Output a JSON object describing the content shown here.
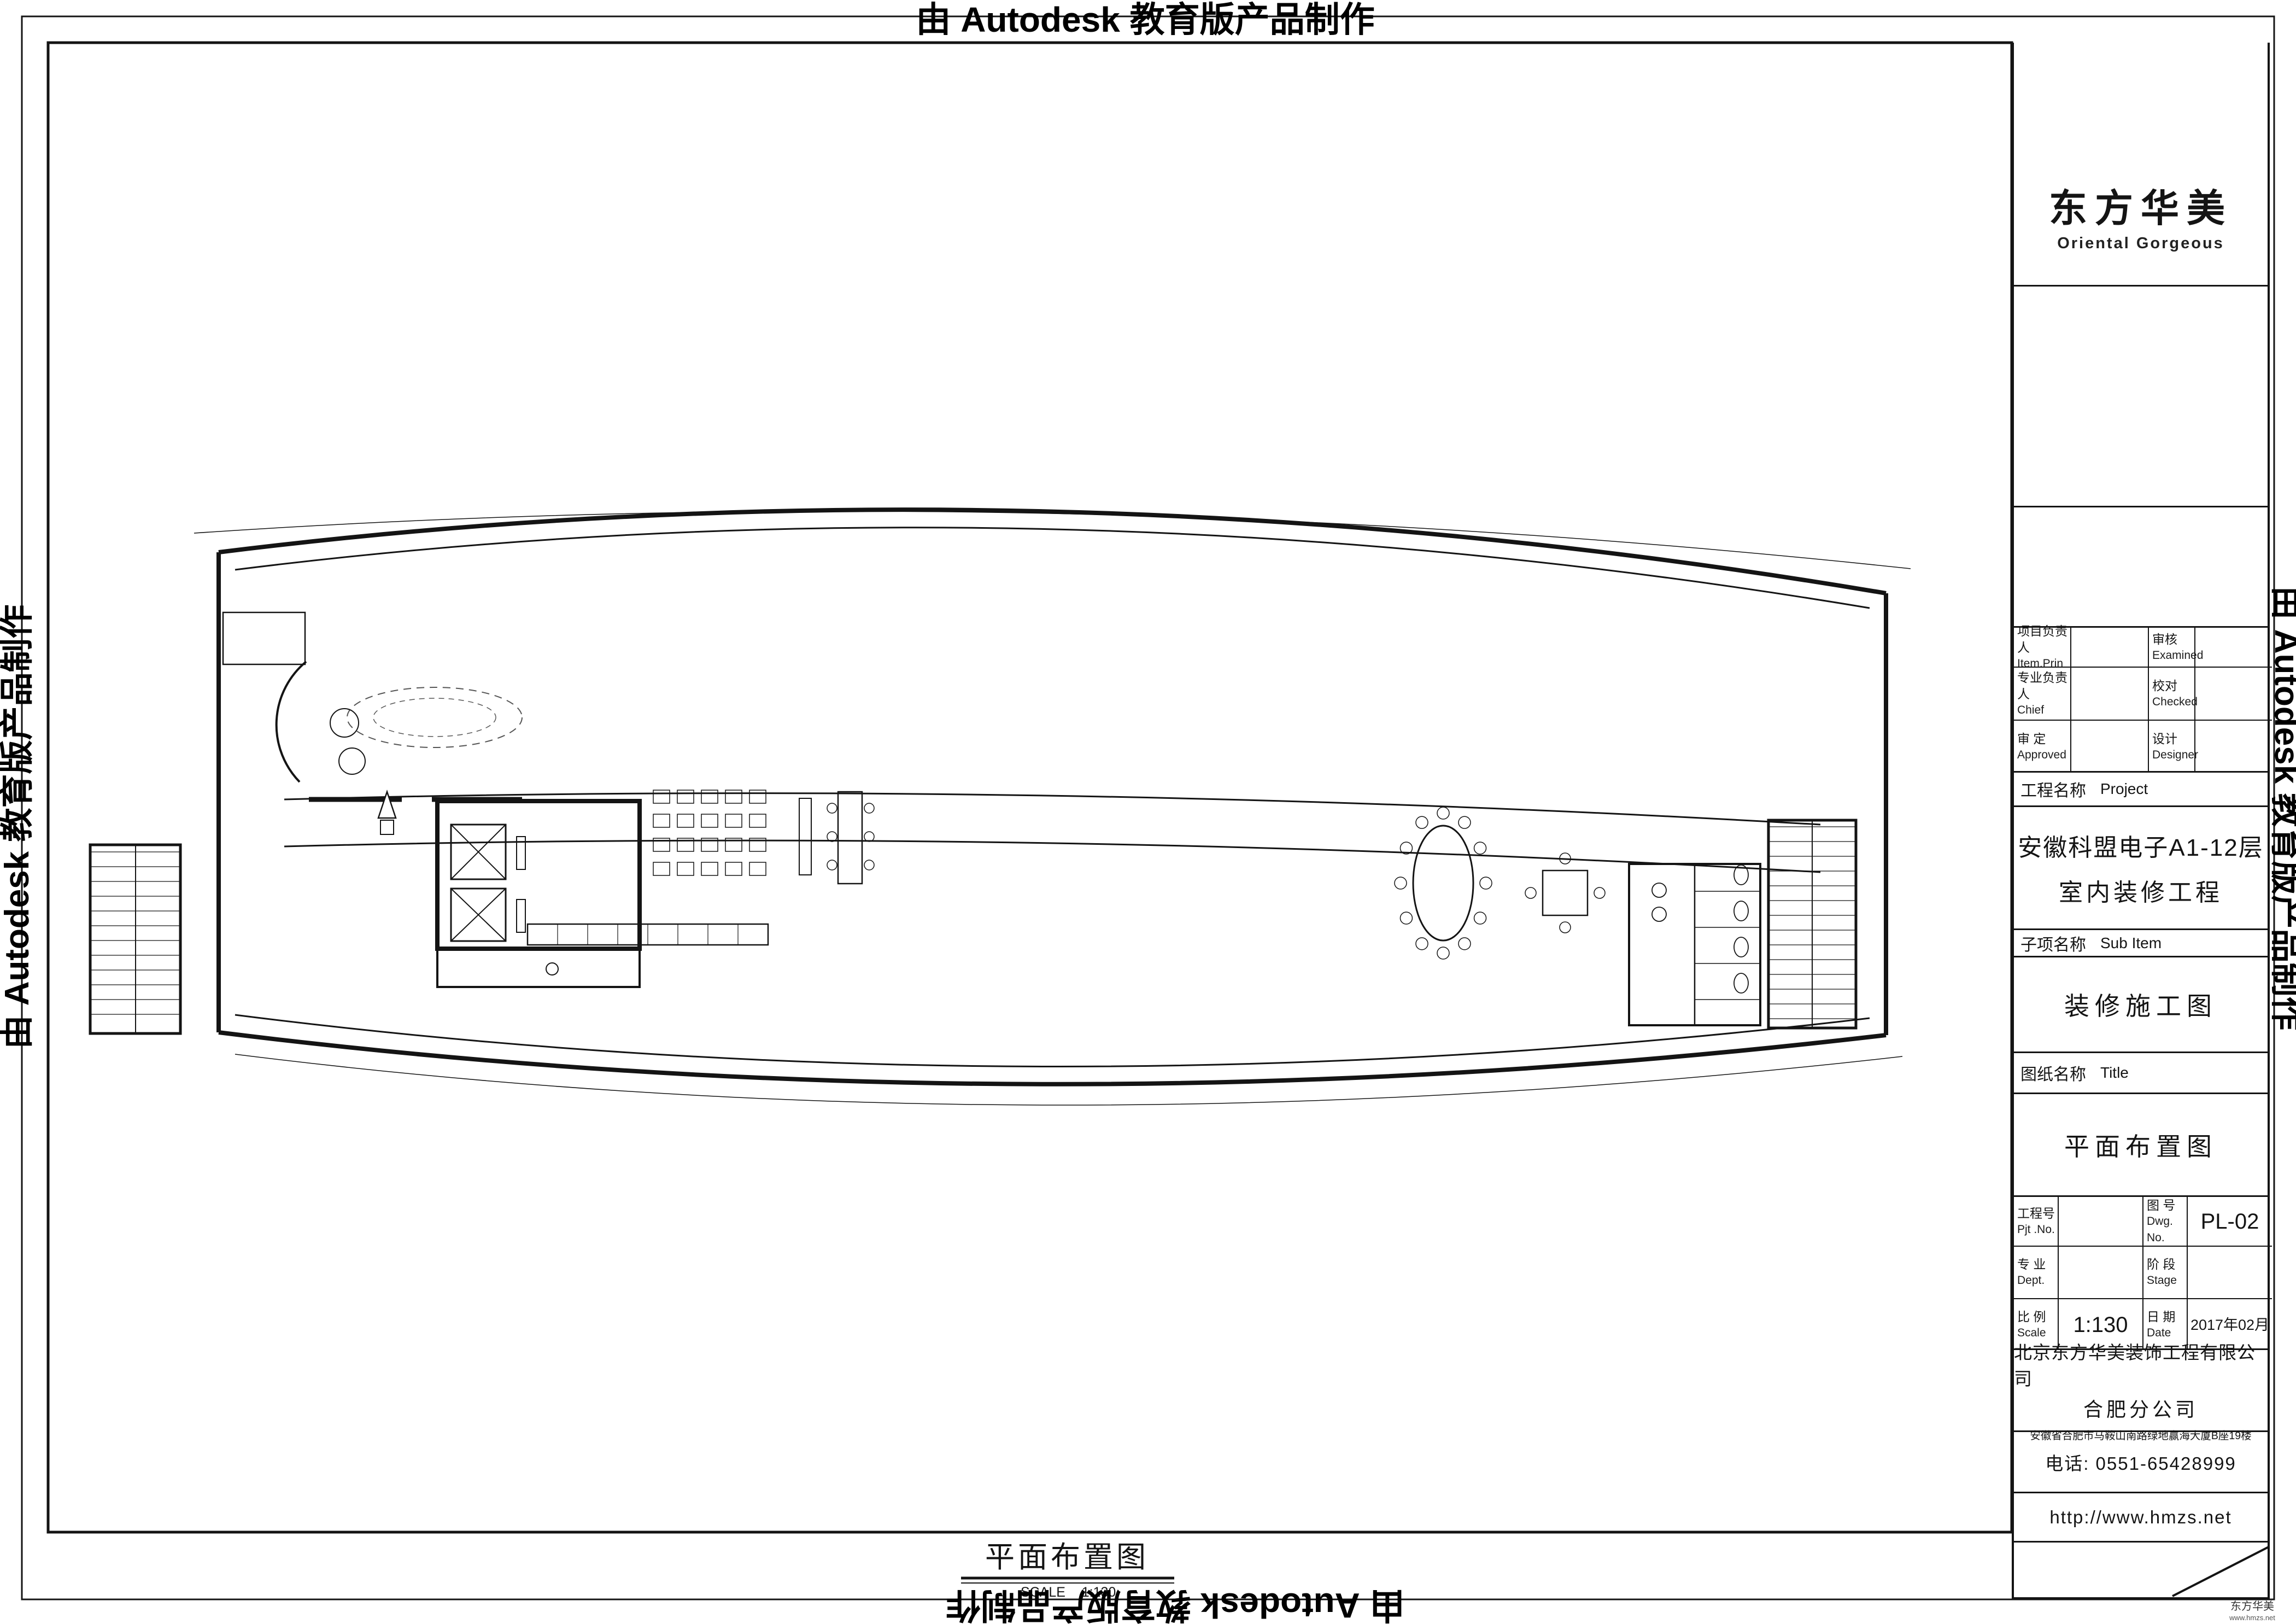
{
  "watermark": "由 Autodesk 教育版产品制作",
  "sheet": {
    "caption_title": "平面布置图",
    "caption_scale_label": "SCALE",
    "caption_scale_value": "1:130",
    "corner_brand": "东方华美",
    "corner_url": "www.hmzs.net"
  },
  "title_block": {
    "logo": {
      "brand_cn": "东方华美",
      "brand_en": "Oriental Gorgeous",
      "accent_color": "#e8141c"
    },
    "copyright_en": [
      "ORIENTAL GORGEOUS EXPRESSLY RESERVES",
      "ITS COMMON LAW COPYRIGHT AND OTHER",
      "PROPERTY RIGHTS IN THESE PLANS.THESE",
      "PLANS ARE NOT TO BE REPRODUCED CHANGED",
      "OR COPIED IN ANY FORM OR MANNER",
      "WHATSOEVER.NOR ARE THEY TO BE ASSIGHED",
      "TO ANY THIRD PARTY WITHOUT FIRST",
      "OBTAINING THE EXPRESSED WRITTEN",
      "PERMISSION AND CONSENT OF ORIENTAL",
      "GORGEOUS"
    ],
    "copyright_cn": [
      "东方华美对本方案拥有版权及所有权。",
      "本方案不得以任何方式修改及复制。",
      "未经东方华美书面授权，本方案不得向",
      "任何第三方转让。"
    ],
    "personnel": {
      "rows": [
        {
          "l1": "项目负责人",
          "l2": "Item.Prin",
          "r1": "审核",
          "r2": "Examined"
        },
        {
          "l1": "专业负责人",
          "l2": "Chief",
          "r1": "校对",
          "r2": "Checked"
        },
        {
          "l1": "审 定",
          "l2": "Approved",
          "r1": "设计",
          "r2": "Designer"
        }
      ]
    },
    "project_label": "工程名称",
    "project_label_en": "Project",
    "project_name_line1": "安徽科盟电子A1-12层",
    "project_name_line2": "室内装修工程",
    "subitem_label": "子项名称",
    "subitem_label_en": "Sub Item",
    "subitem_value": "装修施工图",
    "sheetname_label": "图纸名称",
    "sheetname_label_en": "Title",
    "sheetname_value": "平面布置图",
    "meta": {
      "rows": [
        {
          "l1": "工程号",
          "l2": "Pjt .No.",
          "v1": "",
          "r1": "图 号",
          "r2": "Dwg. No.",
          "v2": "PL-02"
        },
        {
          "l1": "专 业",
          "l2": "Dept.",
          "v1": "",
          "r1": "阶 段",
          "r2": "Stage",
          "v2": ""
        },
        {
          "l1": "比 例",
          "l2": "Scale",
          "v1": "1:130",
          "r1": "日 期",
          "r2": "Date",
          "v2": "2017年02月"
        }
      ]
    },
    "company": {
      "name": "北京东方华美装饰工程有限公司",
      "branch": "合肥分公司",
      "address": "安徽省合肥市马鞍山南路绿地赢海大厦B座19楼",
      "phone": "电话: 0551-65428999",
      "website": "http://www.hmzs.net"
    }
  },
  "plan": {
    "grid": {
      "top_bubbles": [
        "13",
        "12",
        "11",
        "9",
        "8",
        "7",
        "6",
        "5",
        "4",
        "3"
      ],
      "bottom_bubbles": [
        "13",
        "12",
        "11",
        "10",
        "9",
        "7",
        "6",
        "5",
        "4",
        "3"
      ],
      "side_bubbles": [
        "A",
        "B",
        "C",
        "D",
        "E",
        "F"
      ]
    },
    "dims": {
      "top_row1": [
        "2800",
        "3911",
        "2400",
        "9111",
        "9111",
        "9111",
        "9111",
        "3000",
        "",
        "2800"
      ],
      "top_row2": [
        "300",
        "2800",
        "6319",
        "9119",
        "9119",
        "9119",
        "9119",
        "6314",
        "2800",
        "300"
      ],
      "bottom_row1": [
        "2800",
        "3631",
        "2400",
        "8831",
        "8831",
        "8831",
        "8831",
        "3000",
        "3026",
        "2800"
      ],
      "bottom_row2": "1.00",
      "left_col": [
        "300",
        "6000",
        "3000",
        "2100",
        "3000",
        "1900",
        "300"
      ],
      "left_overall": "16000",
      "right_col": [
        "300",
        "6000",
        "3000",
        "2100",
        "3000",
        "1900",
        "300"
      ],
      "right_overall": "16000",
      "detail": {
        "tlc": "TLC1519",
        "pkc": "PKC1819",
        "n350": "350",
        "n1800": "1800"
      }
    },
    "labels": {
      "lobby": "大厅",
      "lobby_area": "(39.5M2)",
      "door": "电动感应玻璃门",
      "entrance": "主入口",
      "north": "N",
      "elevator": "电",
      "water": "水",
      "code": "LDBL-5",
      "phone_room": "电话间",
      "up": "上",
      "down": "下"
    }
  }
}
